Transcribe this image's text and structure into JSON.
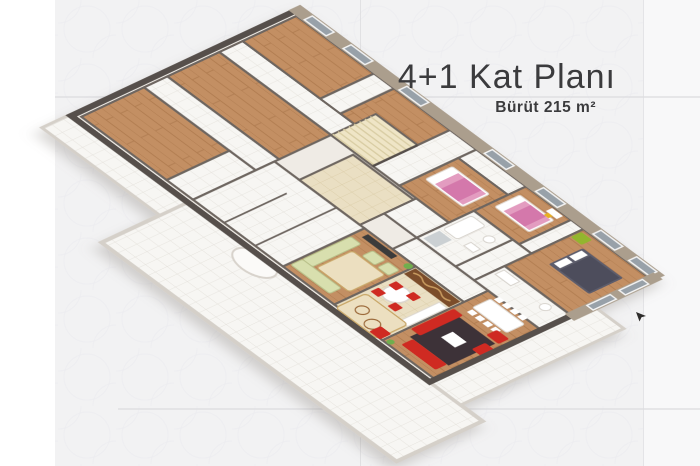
{
  "page": {
    "title": "4+1 Kat Planı",
    "subtitle": "Bürüt 215 m²"
  },
  "illustration": {
    "kind": "3d-isometric-floor-plan"
  },
  "colors": {
    "background": "#f2f2f3",
    "background_left": "#ffffff",
    "background_right": "#f8f8f9",
    "grid_line": "#dcdcdf",
    "pattern_line": "#ebebee",
    "title_text": "#3b3b3d",
    "wall_dark": "#56504b",
    "wall_mid": "#6e6660",
    "slab": "#efebe5",
    "floor_wood": "#c38f63",
    "wood_line": "#b07c50",
    "tile_white": "#f7f6f3",
    "tile_line": "#e4e1db",
    "tile_cream": "#eadfc3",
    "cream_line": "#dbcda8",
    "stairs": "#efe5c6",
    "facade": "#ab9e8d",
    "window_glass": "#98a1a9",
    "window_frame": "#f4f4f4",
    "balcony_edge": "#d5d0c9",
    "bed_pink": "#e39cc0",
    "bed_pink_dark": "#cf6fa5",
    "bed_dark": "#5d5d6c",
    "sofa_red": "#cf2c20",
    "rug_dark": "#3c3038",
    "rug_cream": "#ecdfc0",
    "rug_border": "#caa96a",
    "sofa_green": "#d8dfae",
    "chair_green": "#93b52d",
    "counter_brown": "#7c4d2a",
    "plant_green": "#6fae4e",
    "furniture_white": "#ffffff",
    "tv_dark": "#3b3b3b"
  }
}
